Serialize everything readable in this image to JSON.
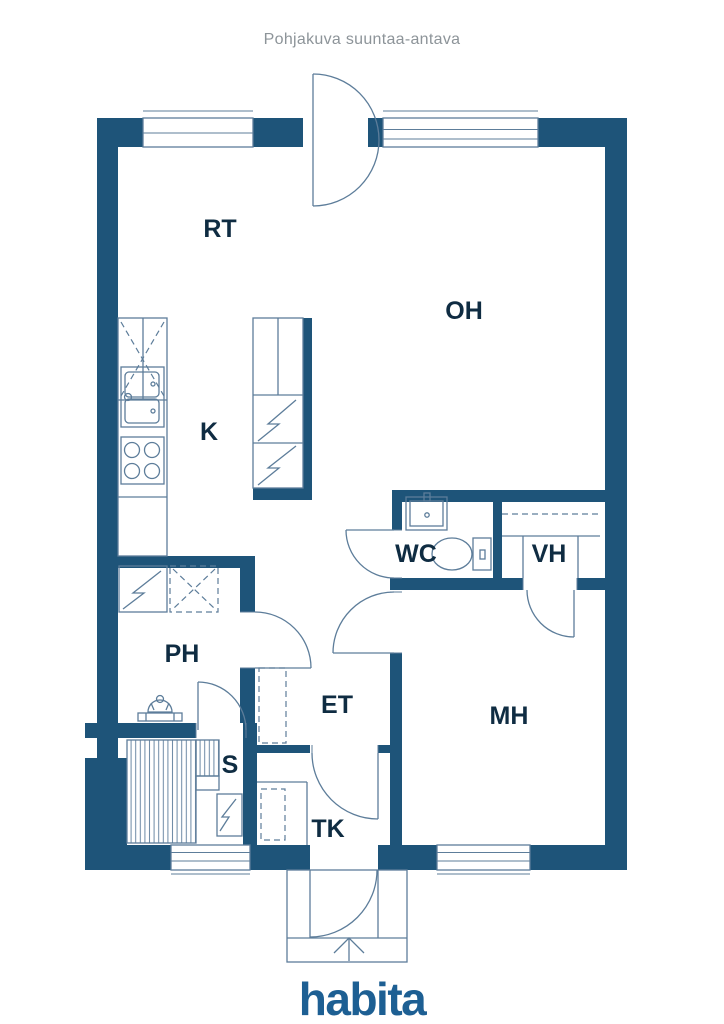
{
  "title": "Pohjakuva suuntaa-antava",
  "brand": "habita",
  "rooms": [
    {
      "id": "rt",
      "label": "RT"
    },
    {
      "id": "oh",
      "label": "OH"
    },
    {
      "id": "k",
      "label": "K"
    },
    {
      "id": "wc",
      "label": "WC"
    },
    {
      "id": "vh",
      "label": "VH"
    },
    {
      "id": "ph",
      "label": "PH"
    },
    {
      "id": "et",
      "label": "ET"
    },
    {
      "id": "mh",
      "label": "MH"
    },
    {
      "id": "s",
      "label": "S"
    },
    {
      "id": "tk",
      "label": "TK"
    }
  ],
  "colors": {
    "wall": "#1e5479",
    "line": "#5d7d9a",
    "label": "#0f2c42",
    "title": "#8d9499",
    "brand": "#1d5f93"
  }
}
